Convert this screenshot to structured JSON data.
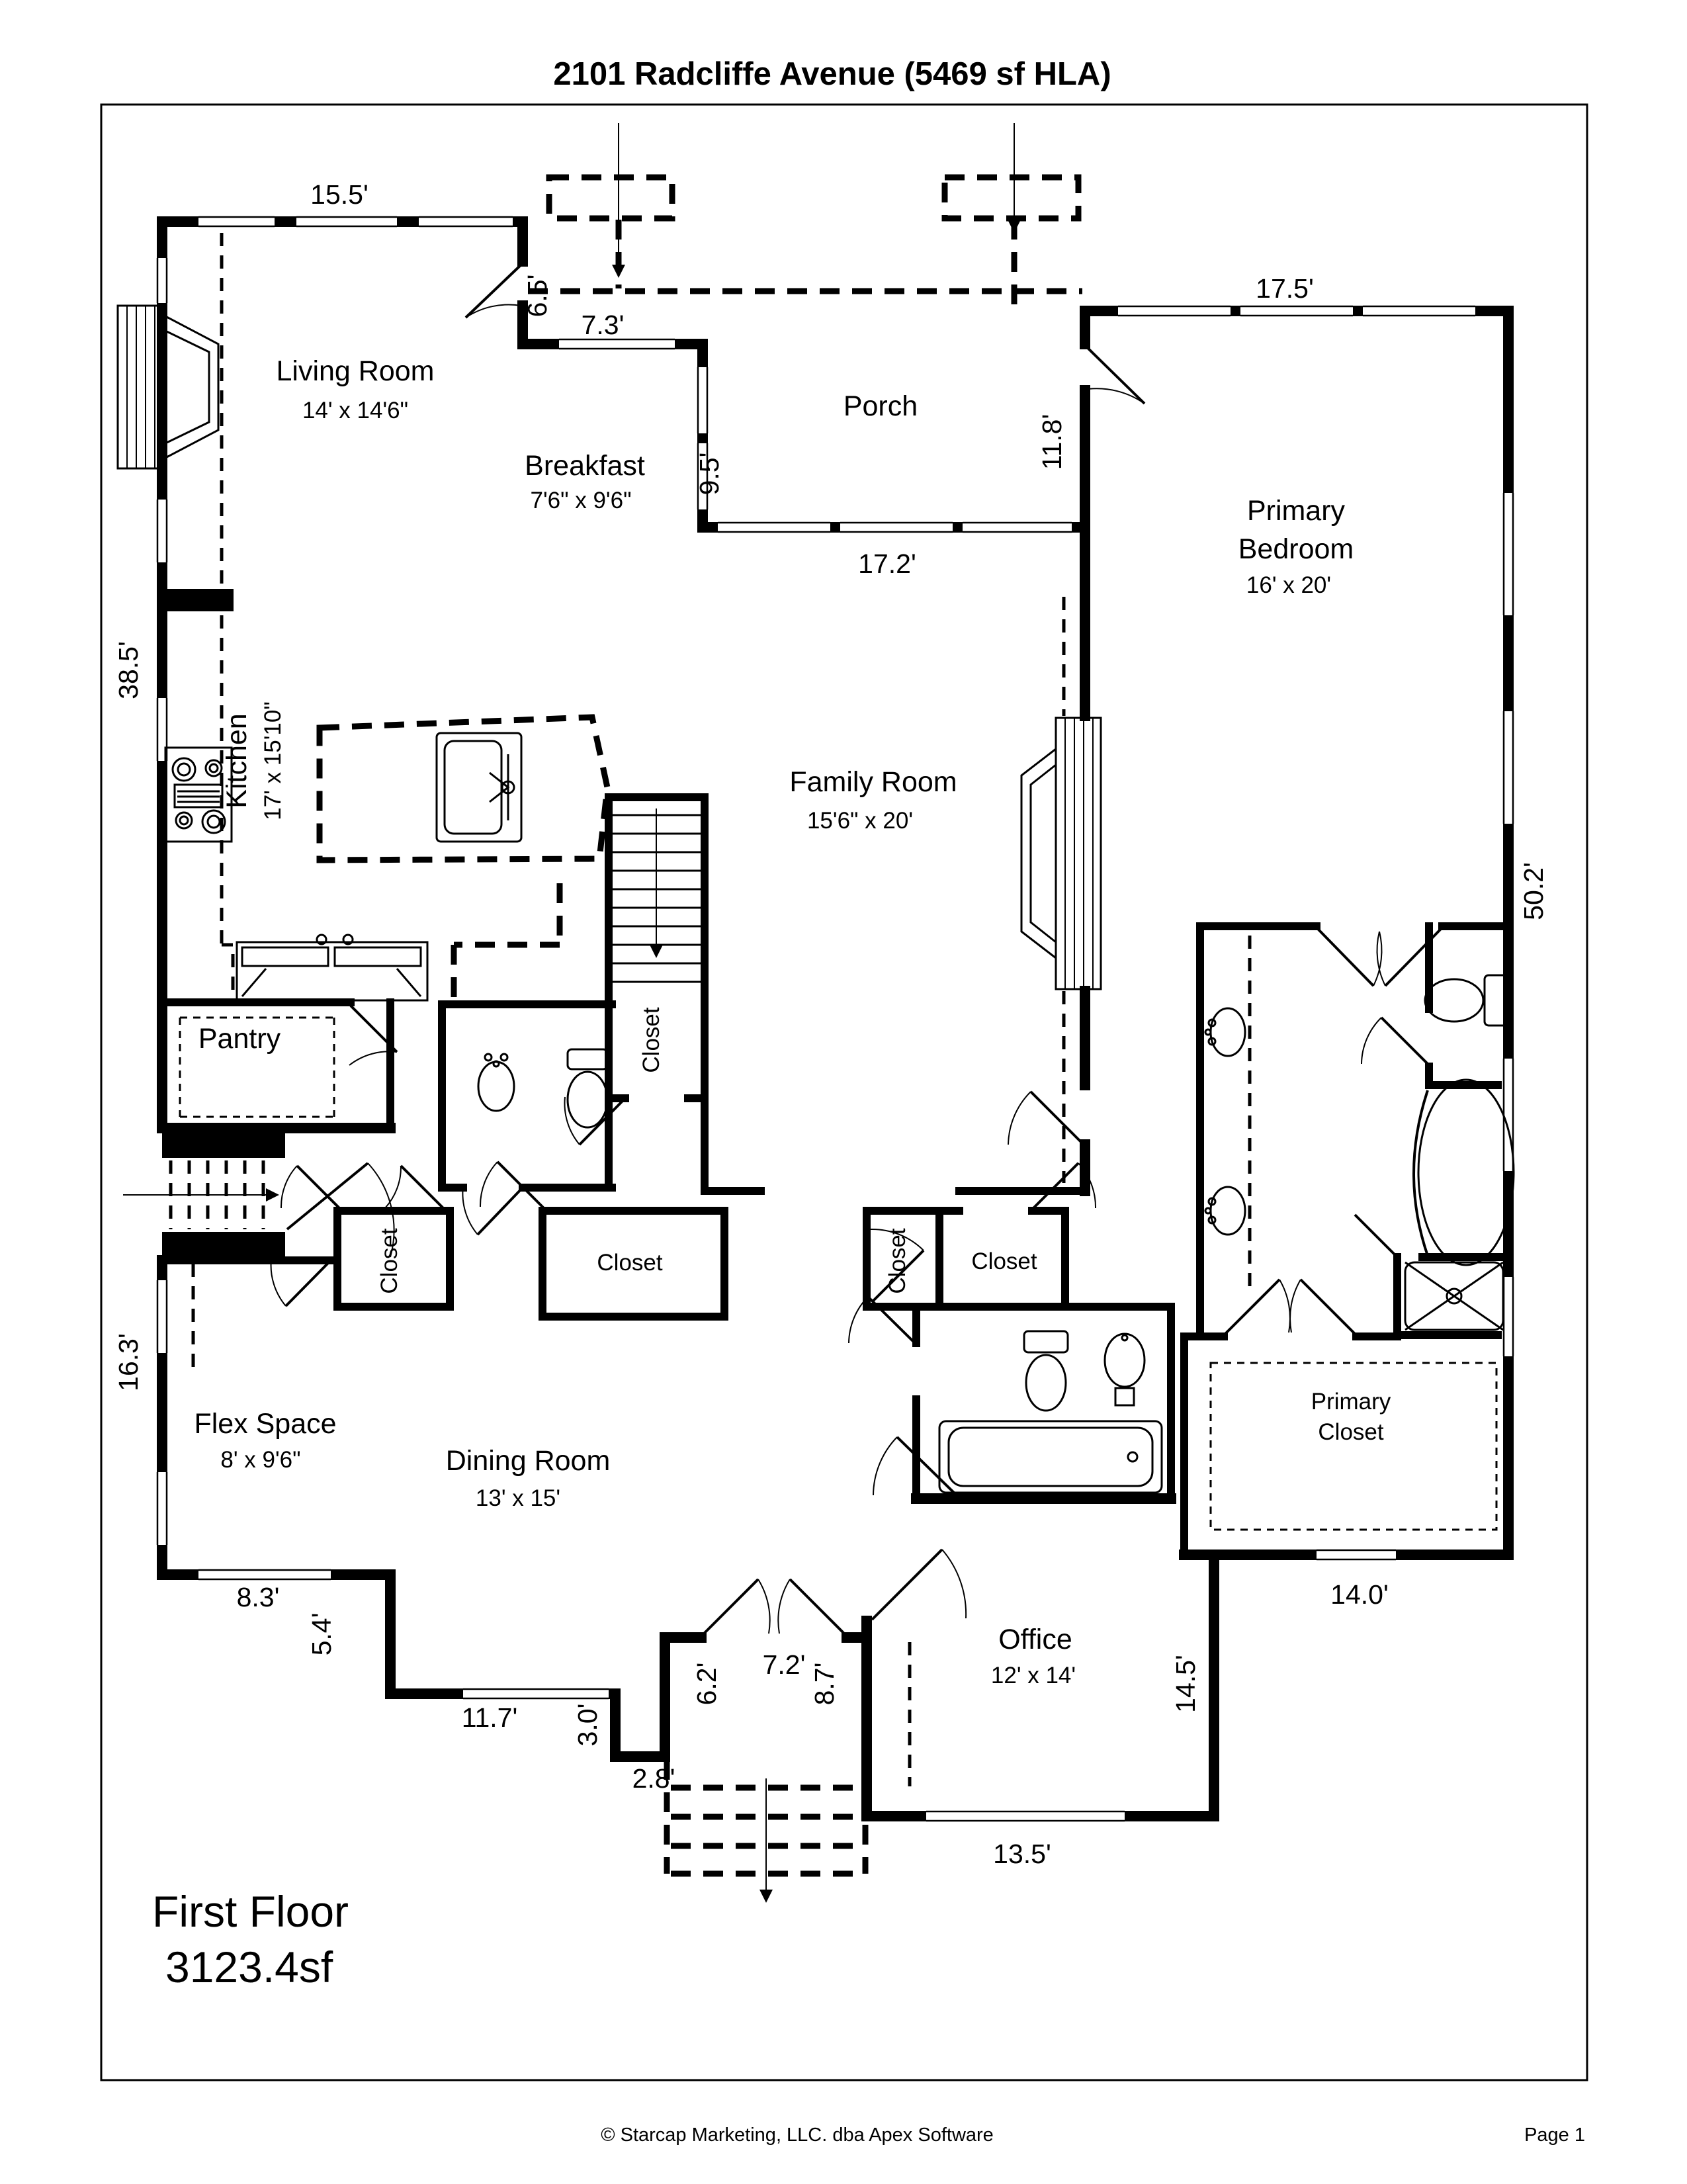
{
  "title": "2101 Radcliffe Avenue (5469 sf HLA)",
  "rooms": {
    "living": {
      "name": "Living Room",
      "dims": "14' x 14'6\""
    },
    "breakfast": {
      "name": "Breakfast",
      "dims": "7'6\" x 9'6\""
    },
    "porch": {
      "name": "Porch"
    },
    "primary_bedroom": {
      "name_line1": "Primary",
      "name_line2": "Bedroom",
      "dims": "16' x 20'"
    },
    "kitchen": {
      "name": "Kitchen",
      "dims": "17' x 15'10\""
    },
    "family": {
      "name": "Family Room",
      "dims": "15'6\" x 20'"
    },
    "pantry": {
      "name": "Pantry"
    },
    "flex": {
      "name": "Flex Space",
      "dims": "8' x 9'6\""
    },
    "dining": {
      "name": "Dining Room",
      "dims": "13' x 15'"
    },
    "office": {
      "name": "Office",
      "dims": "12' x 14'"
    },
    "primary_closet": {
      "name_line1": "Primary",
      "name_line2": "Closet"
    },
    "closets": {
      "under_stairs": "Closet",
      "hall_left": "Closet",
      "hall_mid": "Closet",
      "office_small": "Closet",
      "office_right": "Closet"
    }
  },
  "dims": {
    "living_top": "15.5'",
    "living_right": "6.5'",
    "breakfast_top": "7.3'",
    "breakfast_right": "9.5'",
    "porch_right": "11.8'",
    "bedroom_top": "17.5'",
    "family_top": "17.2'",
    "left_upper": "38.5'",
    "right_side": "50.2'",
    "left_lower": "16.3'",
    "flex_bottom": "8.3'",
    "jog_left": "5.4'",
    "dining_bottom": "11.7'",
    "entry_jog_vert": "3.0'",
    "entry_jog_horiz": "2.8'",
    "foyer_left": "6.2'",
    "foyer_right": "8.7'",
    "foyer_width": "7.2'",
    "office_bottom": "13.5'",
    "office_right": "14.5'",
    "primary_closet_bottom": "14.0'"
  },
  "floor_summary": {
    "line1": "First Floor",
    "line2": "3123.4sf"
  },
  "footer": {
    "copyright": "© Starcap Marketing, LLC. dba Apex Software",
    "page": "Page 1"
  },
  "colors": {
    "ink": "#000000",
    "paper": "#ffffff"
  }
}
